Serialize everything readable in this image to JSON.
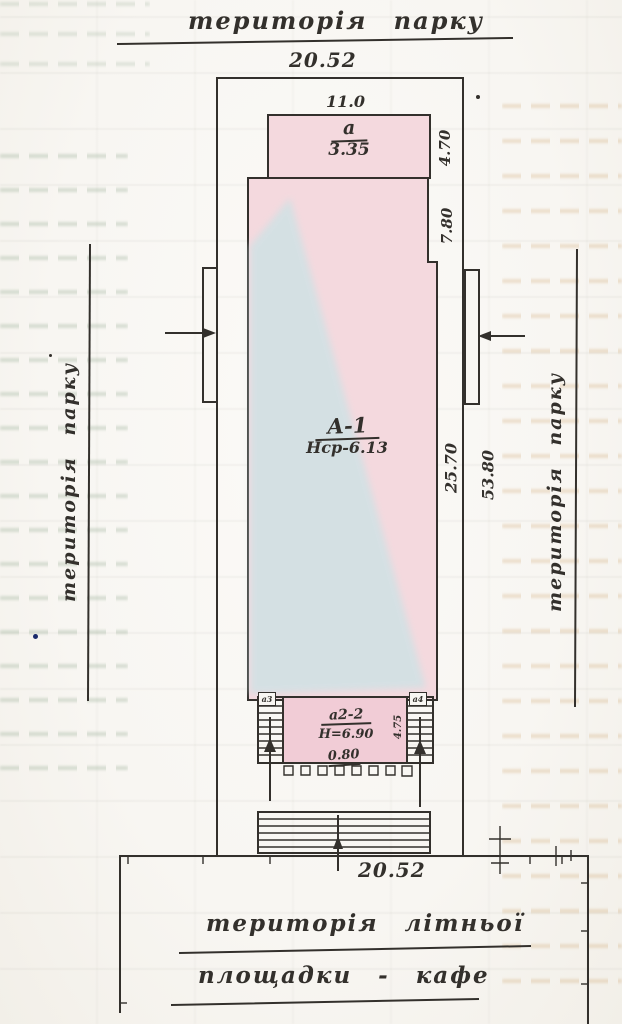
{
  "colors": {
    "ink": "#33302c",
    "pink": "#f4d9de",
    "pink2": "#f1ccd6",
    "blue": "#cde2e5",
    "paper": "#f8f6f2",
    "bleedgreen": "#8aa388",
    "bleedtan": "#c89a5e",
    "dotblue": "#1a2a6b"
  },
  "labels": {
    "park_top": "територія парку",
    "park_left": "територія парку",
    "park_right": "територія парку",
    "cafe_line1": "територія літньої",
    "cafe_line2": "площадки - кафе"
  },
  "dims": {
    "plot_width_top": "20.52",
    "annex_width": "11.0",
    "annex_depth": "4.70",
    "notch_depth": "7.80",
    "building_length": "25.70",
    "site_length": "53.80",
    "porch_depth": "4.75",
    "porch_pitch": "0.80",
    "plot_width_bottom": "20.52"
  },
  "structures": {
    "main_label": "А-1",
    "main_height": "Нср-6.13",
    "annex_label": "а",
    "annex_area": "3.35",
    "porch_label": "а2-2",
    "porch_height": "Н=6.90",
    "stair_left": "а3",
    "stair_right": "а4"
  }
}
